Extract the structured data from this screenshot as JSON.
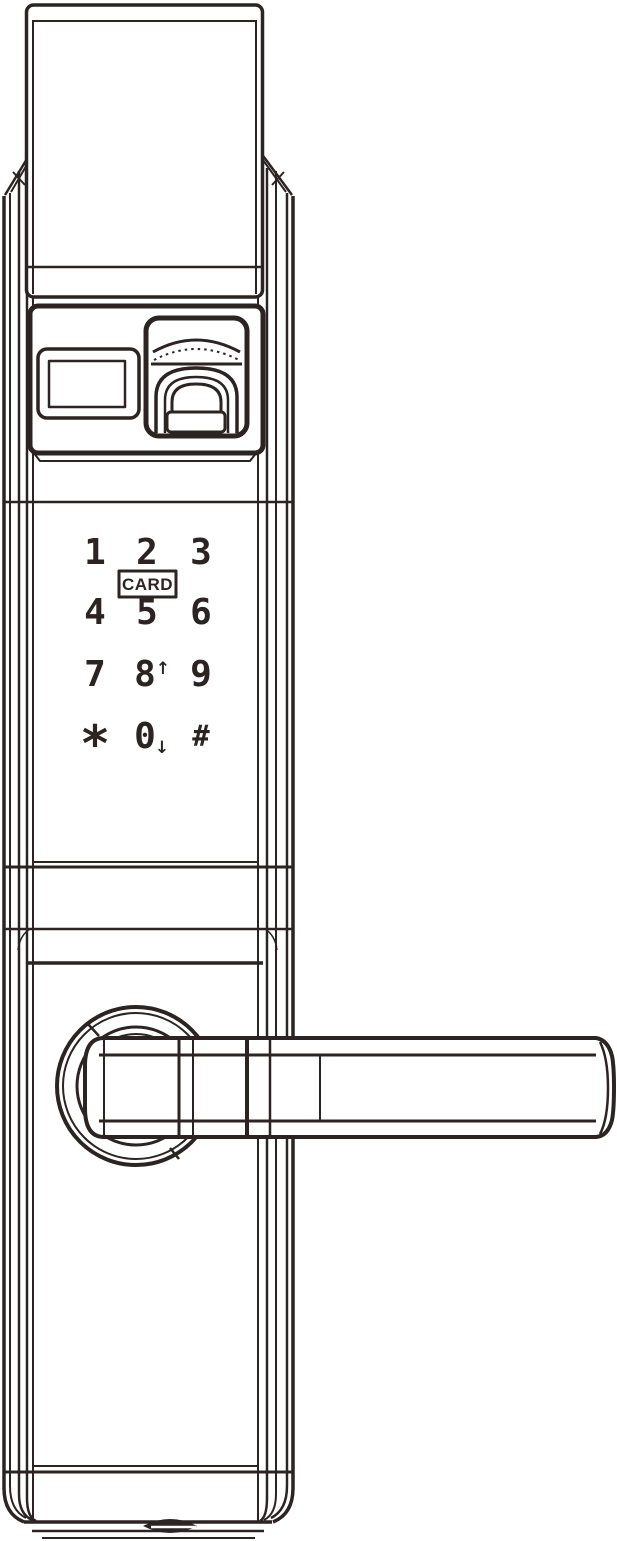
{
  "colors": {
    "line": "#2b2422",
    "background": "#ffffff"
  },
  "keypad": {
    "card_label": "CARD",
    "keys": [
      {
        "label": "1"
      },
      {
        "label": "2"
      },
      {
        "label": "3"
      },
      {
        "label": "4"
      },
      {
        "label": "5"
      },
      {
        "label": "6"
      },
      {
        "label": "7"
      },
      {
        "label": "8",
        "suffix": "↑"
      },
      {
        "label": "9"
      },
      {
        "label": "*"
      },
      {
        "label": "0",
        "suffix": "↓"
      },
      {
        "label": "#"
      }
    ]
  }
}
